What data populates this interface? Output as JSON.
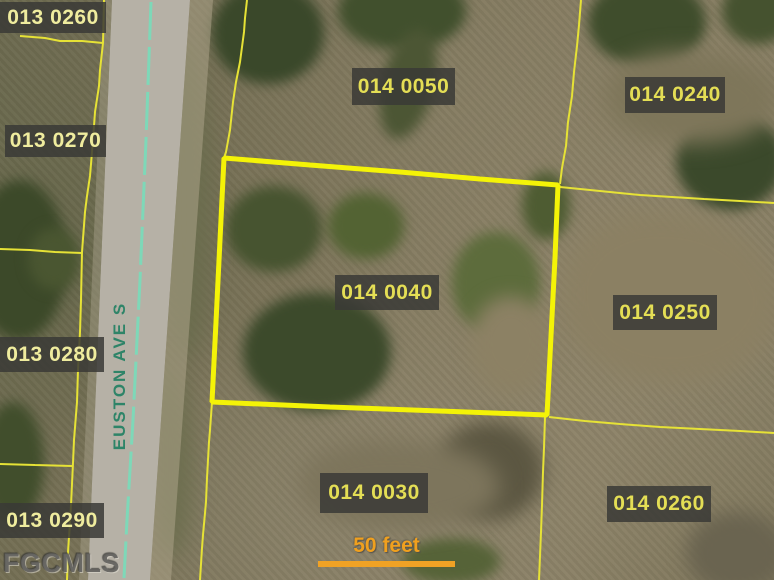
{
  "map": {
    "description": "Aerial parcel map with lot-line overlay",
    "highlighted_parcel": "014 0040"
  },
  "parcels": [
    {
      "label": "013 0260"
    },
    {
      "label": "013 0270"
    },
    {
      "label": "013 0280"
    },
    {
      "label": "013 0290"
    },
    {
      "label": "014 0050"
    },
    {
      "label": "014 0240"
    },
    {
      "label": "014 0040",
      "highlighted": true
    },
    {
      "label": "014 0250"
    },
    {
      "label": "014 0030"
    },
    {
      "label": "014 0260"
    }
  ],
  "street": {
    "name": "EUSTON AVE S"
  },
  "scale_bar": {
    "label": "50 feet"
  },
  "watermark": {
    "text": "FGCMLS"
  },
  "colors": {
    "parcel_line": "#e6e236",
    "highlight_line": "#f4f307",
    "label_background": "#3a3a36",
    "label_text_013": "#efec9e",
    "label_text_014": "#e4de55",
    "road_pavement": "#b6b1a6",
    "road_centerline": "#7ed8b8",
    "street_text": "#2e8468",
    "scale_orange": "#f0a225"
  }
}
